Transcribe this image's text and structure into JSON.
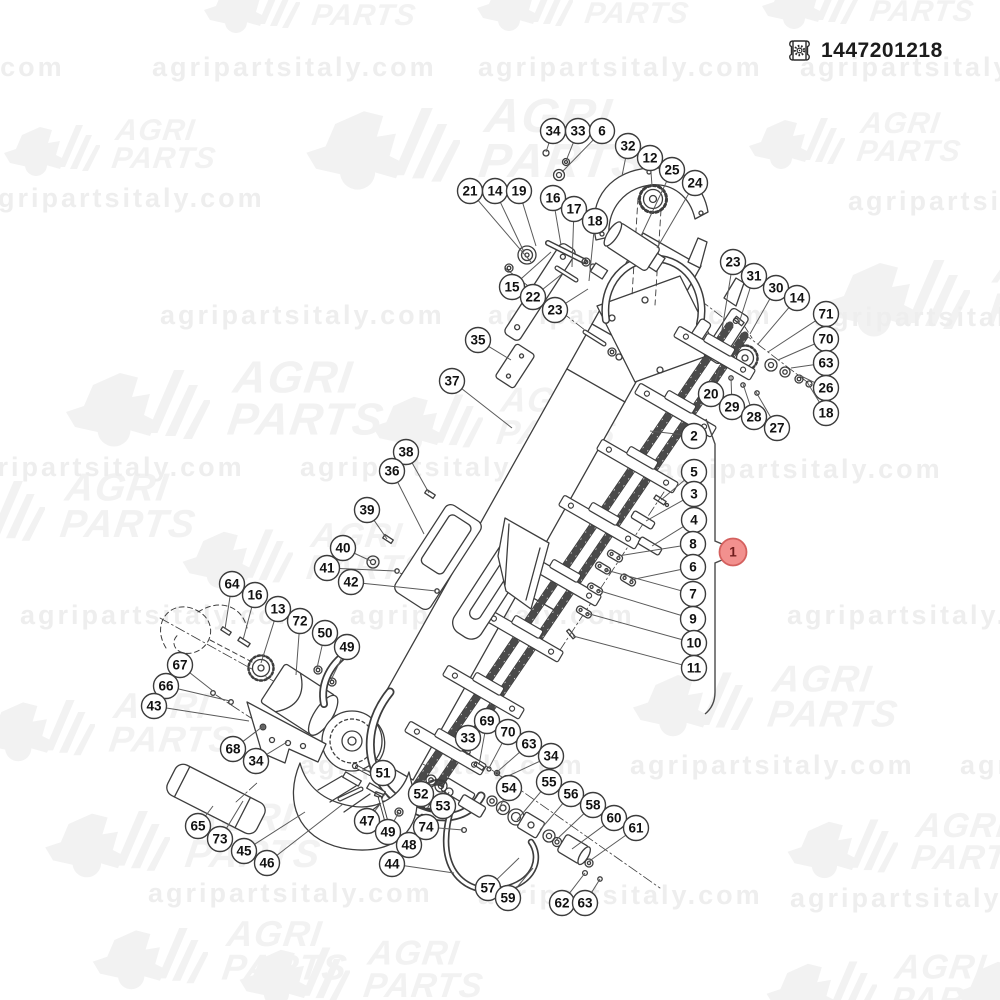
{
  "header": {
    "part_number": "1447201218",
    "icon": "certificate-gear-icon"
  },
  "watermark": {
    "url_text": "agripartsitaly.com",
    "logo_line1": "AGRI",
    "logo_line2": "PARTS",
    "logo_color": "#f2f2f2",
    "url_color": "#eeeeee",
    "logos": [
      {
        "x": 200,
        "y": -28,
        "s": 1
      },
      {
        "x": 473,
        "y": -30,
        "s": 1
      },
      {
        "x": 758,
        "y": -32,
        "s": 1
      },
      {
        "x": 0,
        "y": 115,
        "s": 1
      },
      {
        "x": 300,
        "y": 92,
        "s": 1.6
      },
      {
        "x": 745,
        "y": 108,
        "s": 1
      },
      {
        "x": 820,
        "y": 245,
        "s": 1.5
      },
      {
        "x": 60,
        "y": 355,
        "s": 1.5
      },
      {
        "x": 368,
        "y": 383,
        "s": 1.15
      },
      {
        "x": -85,
        "y": 468,
        "s": 1.3
      },
      {
        "x": 178,
        "y": 518,
        "s": 1.15
      },
      {
        "x": 628,
        "y": 660,
        "s": 1.25
      },
      {
        "x": -25,
        "y": 688,
        "s": 1.2
      },
      {
        "x": 40,
        "y": 798,
        "s": 1.3
      },
      {
        "x": 783,
        "y": 808,
        "s": 1.15
      },
      {
        "x": 88,
        "y": 916,
        "s": 1.2
      },
      {
        "x": 235,
        "y": 936,
        "s": 1.15
      },
      {
        "x": 762,
        "y": 950,
        "s": 1.15
      },
      {
        "x": 952,
        "y": 948,
        "s": 1.15
      }
    ],
    "urls": [
      {
        "x": -220,
        "y": 52
      },
      {
        "x": 152,
        "y": 52
      },
      {
        "x": 478,
        "y": 52
      },
      {
        "x": 800,
        "y": 52
      },
      {
        "x": -20,
        "y": 183
      },
      {
        "x": 848,
        "y": 186
      },
      {
        "x": 160,
        "y": 300
      },
      {
        "x": 488,
        "y": 300
      },
      {
        "x": 814,
        "y": 302
      },
      {
        "x": -40,
        "y": 452
      },
      {
        "x": 300,
        "y": 452
      },
      {
        "x": 658,
        "y": 454
      },
      {
        "x": 20,
        "y": 600
      },
      {
        "x": 350,
        "y": 600
      },
      {
        "x": 787,
        "y": 600
      },
      {
        "x": 300,
        "y": 750
      },
      {
        "x": 630,
        "y": 750
      },
      {
        "x": 960,
        "y": 750
      },
      {
        "x": 148,
        "y": 878
      },
      {
        "x": 478,
        "y": 880
      },
      {
        "x": 790,
        "y": 883
      }
    ]
  },
  "diagram": {
    "colors": {
      "balloon_fill": "#ffffff",
      "balloon_stroke": "#3c3c3c",
      "number_color": "#111111",
      "leader": "#5a5a5a",
      "red_fill": "#f2908e",
      "red_stroke": "#d4605e",
      "red_number": "#701c1c"
    },
    "main_balloon": {
      "n": "1",
      "x": 733,
      "y": 552
    },
    "bracket": {
      "tail_top_x": 706,
      "tail_top_y": 419,
      "x": 715,
      "top_y": 444,
      "notch_top": 541,
      "tip_x": 741,
      "tip_y": 552,
      "notch_bottom": 563,
      "bottom_y": 692,
      "tail_bottom_x": 705,
      "tail_bottom_y": 714
    },
    "balloons": [
      {
        "n": "34",
        "x": 553,
        "y": 131,
        "tx": 546,
        "ty": 152
      },
      {
        "n": "33",
        "x": 578,
        "y": 131,
        "tx": 566,
        "ty": 161
      },
      {
        "n": "6",
        "x": 602,
        "y": 131,
        "tx": 562,
        "ty": 172
      },
      {
        "n": "32",
        "x": 628,
        "y": 146,
        "tx": 622,
        "ty": 176
      },
      {
        "n": "12",
        "x": 650,
        "y": 158,
        "tx": 652,
        "ty": 186
      },
      {
        "n": "25",
        "x": 672,
        "y": 170,
        "tx": 641,
        "ty": 236
      },
      {
        "n": "24",
        "x": 695,
        "y": 183,
        "tx": 657,
        "ty": 248
      },
      {
        "n": "21",
        "x": 470,
        "y": 191,
        "tx": 531,
        "ty": 262
      },
      {
        "n": "14",
        "x": 495,
        "y": 191,
        "tx": 524,
        "ty": 252
      },
      {
        "n": "19",
        "x": 519,
        "y": 191,
        "tx": 536,
        "ty": 246
      },
      {
        "n": "16",
        "x": 553,
        "y": 198,
        "tx": 561,
        "ty": 245
      },
      {
        "n": "17",
        "x": 574,
        "y": 209,
        "tx": 572,
        "ty": 267
      },
      {
        "n": "18",
        "x": 595,
        "y": 221,
        "tx": 589,
        "ty": 281
      },
      {
        "n": "15",
        "x": 512,
        "y": 287,
        "tx": 551,
        "ty": 252
      },
      {
        "n": "22",
        "x": 533,
        "y": 297,
        "tx": 562,
        "ty": 274
      },
      {
        "n": "23",
        "x": 555,
        "y": 310,
        "tx": 588,
        "ty": 289
      },
      {
        "n": "35",
        "x": 478,
        "y": 340,
        "tx": 511,
        "ty": 360
      },
      {
        "n": "37",
        "x": 452,
        "y": 381,
        "tx": 512,
        "ty": 428
      },
      {
        "n": "23",
        "x": 733,
        "y": 262,
        "tx": 722,
        "ty": 330
      },
      {
        "n": "31",
        "x": 754,
        "y": 276,
        "tx": 739,
        "ty": 323
      },
      {
        "n": "30",
        "x": 776,
        "y": 288,
        "tx": 750,
        "ty": 334
      },
      {
        "n": "14",
        "x": 797,
        "y": 298,
        "tx": 758,
        "ty": 344
      },
      {
        "n": "71",
        "x": 826,
        "y": 314,
        "tx": 768,
        "ty": 352
      },
      {
        "n": "70",
        "x": 826,
        "y": 339,
        "tx": 778,
        "ty": 360
      },
      {
        "n": "63",
        "x": 826,
        "y": 363,
        "tx": 791,
        "ty": 368
      },
      {
        "n": "26",
        "x": 826,
        "y": 388,
        "tx": 801,
        "ty": 376
      },
      {
        "n": "18",
        "x": 826,
        "y": 413,
        "tx": 807,
        "ty": 382
      },
      {
        "n": "20",
        "x": 711,
        "y": 394,
        "tx": 719,
        "ty": 370
      },
      {
        "n": "29",
        "x": 732,
        "y": 407,
        "tx": 731,
        "ty": 377
      },
      {
        "n": "28",
        "x": 754,
        "y": 417,
        "tx": 743,
        "ty": 384
      },
      {
        "n": "27",
        "x": 777,
        "y": 428,
        "tx": 756,
        "ty": 392
      },
      {
        "n": "2",
        "x": 694,
        "y": 436,
        "tx": 650,
        "ty": 431
      },
      {
        "n": "5",
        "x": 694,
        "y": 472,
        "tx": 661,
        "ty": 500
      },
      {
        "n": "3",
        "x": 694,
        "y": 494,
        "tx": 646,
        "ty": 521
      },
      {
        "n": "4",
        "x": 694,
        "y": 520,
        "tx": 652,
        "ty": 546
      },
      {
        "n": "8",
        "x": 693,
        "y": 544,
        "tx": 618,
        "ty": 556
      },
      {
        "n": "6",
        "x": 693,
        "y": 567,
        "tx": 630,
        "ty": 580
      },
      {
        "n": "7",
        "x": 693,
        "y": 594,
        "tx": 606,
        "ty": 570
      },
      {
        "n": "9",
        "x": 693,
        "y": 619,
        "tx": 597,
        "ty": 590
      },
      {
        "n": "10",
        "x": 694,
        "y": 643,
        "tx": 586,
        "ty": 613
      },
      {
        "n": "11",
        "x": 694,
        "y": 668,
        "tx": 573,
        "ty": 636
      },
      {
        "n": "38",
        "x": 406,
        "y": 452,
        "tx": 429,
        "ty": 493
      },
      {
        "n": "36",
        "x": 392,
        "y": 471,
        "tx": 424,
        "ty": 534
      },
      {
        "n": "39",
        "x": 367,
        "y": 510,
        "tx": 387,
        "ty": 539
      },
      {
        "n": "40",
        "x": 343,
        "y": 548,
        "tx": 371,
        "ty": 561
      },
      {
        "n": "41",
        "x": 327,
        "y": 568,
        "tx": 396,
        "ty": 571
      },
      {
        "n": "42",
        "x": 351,
        "y": 582,
        "tx": 436,
        "ty": 591
      },
      {
        "n": "64",
        "x": 232,
        "y": 584,
        "tx": 225,
        "ty": 629
      },
      {
        "n": "16",
        "x": 255,
        "y": 595,
        "tx": 243,
        "ty": 640
      },
      {
        "n": "13",
        "x": 278,
        "y": 609,
        "tx": 261,
        "ty": 663
      },
      {
        "n": "72",
        "x": 300,
        "y": 621,
        "tx": 296,
        "ty": 675
      },
      {
        "n": "50",
        "x": 325,
        "y": 633,
        "tx": 317,
        "ty": 668
      },
      {
        "n": "49",
        "x": 347,
        "y": 647,
        "tx": 331,
        "ty": 680
      },
      {
        "n": "67",
        "x": 180,
        "y": 665,
        "tx": 213,
        "ty": 691
      },
      {
        "n": "66",
        "x": 166,
        "y": 686,
        "tx": 230,
        "ty": 701
      },
      {
        "n": "43",
        "x": 154,
        "y": 706,
        "tx": 249,
        "ty": 721
      },
      {
        "n": "68",
        "x": 233,
        "y": 749,
        "tx": 262,
        "ty": 727
      },
      {
        "n": "34",
        "x": 256,
        "y": 761,
        "tx": 287,
        "ty": 742
      },
      {
        "n": "65",
        "x": 198,
        "y": 826,
        "tx": 213,
        "ty": 806
      },
      {
        "n": "73",
        "x": 220,
        "y": 839,
        "tx": 243,
        "ty": 801
      },
      {
        "n": "45",
        "x": 244,
        "y": 851,
        "tx": 305,
        "ty": 812
      },
      {
        "n": "46",
        "x": 267,
        "y": 863,
        "tx": 343,
        "ty": 804
      },
      {
        "n": "51",
        "x": 383,
        "y": 773,
        "tx": 362,
        "ty": 770
      },
      {
        "n": "52",
        "x": 421,
        "y": 794,
        "tx": 431,
        "ty": 780
      },
      {
        "n": "53",
        "x": 443,
        "y": 806,
        "tx": 449,
        "ty": 792
      },
      {
        "n": "47",
        "x": 367,
        "y": 821,
        "tx": 381,
        "ty": 803
      },
      {
        "n": "49",
        "x": 388,
        "y": 832,
        "tx": 399,
        "ty": 812
      },
      {
        "n": "48",
        "x": 409,
        "y": 845,
        "tx": 426,
        "ty": 820
      },
      {
        "n": "74",
        "x": 426,
        "y": 827,
        "tx": 463,
        "ty": 830
      },
      {
        "n": "44",
        "x": 392,
        "y": 864,
        "tx": 454,
        "ty": 873
      },
      {
        "n": "69",
        "x": 487,
        "y": 721,
        "tx": 479,
        "ty": 765
      },
      {
        "n": "33",
        "x": 468,
        "y": 738,
        "tx": 468,
        "ty": 752
      },
      {
        "n": "70",
        "x": 508,
        "y": 732,
        "tx": 489,
        "ty": 768
      },
      {
        "n": "63",
        "x": 529,
        "y": 744,
        "tx": 497,
        "ty": 772
      },
      {
        "n": "34",
        "x": 551,
        "y": 756,
        "tx": 506,
        "ty": 777
      },
      {
        "n": "54",
        "x": 509,
        "y": 788,
        "tx": 498,
        "ty": 811
      },
      {
        "n": "55",
        "x": 549,
        "y": 782,
        "tx": 517,
        "ty": 820
      },
      {
        "n": "56",
        "x": 571,
        "y": 794,
        "tx": 540,
        "ty": 830
      },
      {
        "n": "58",
        "x": 593,
        "y": 805,
        "tx": 556,
        "ty": 840
      },
      {
        "n": "60",
        "x": 614,
        "y": 818,
        "tx": 572,
        "ty": 849
      },
      {
        "n": "61",
        "x": 636,
        "y": 828,
        "tx": 588,
        "ty": 862
      },
      {
        "n": "57",
        "x": 488,
        "y": 888,
        "tx": 519,
        "ty": 858
      },
      {
        "n": "59",
        "x": 508,
        "y": 898,
        "tx": 533,
        "ty": 868
      },
      {
        "n": "62",
        "x": 562,
        "y": 903,
        "tx": 585,
        "ty": 873
      },
      {
        "n": "63",
        "x": 585,
        "y": 903,
        "tx": 600,
        "ty": 879
      }
    ]
  }
}
